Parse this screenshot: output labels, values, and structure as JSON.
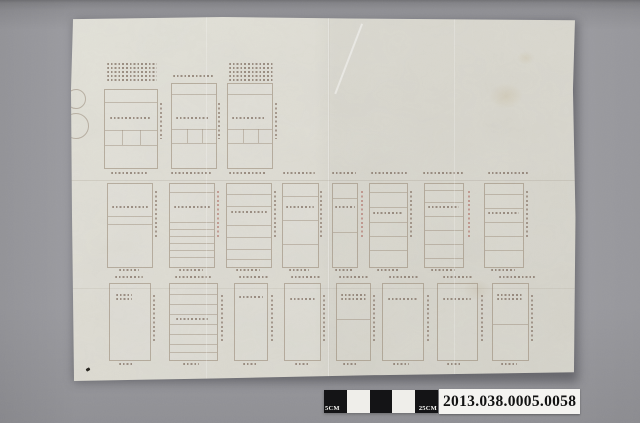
{
  "photo": {
    "accession_label": "2013.038.0005.0058",
    "scale_bar": {
      "label_left": "5CM",
      "label_right": "25CM",
      "segments": [
        "black",
        "white",
        "black",
        "white",
        "black"
      ]
    },
    "colors": {
      "background": "#9c9ca1",
      "paper": "#dedcd3",
      "scale_black": "#141416",
      "scale_white": "#efeeea",
      "label_bg": "#f4f3f0",
      "label_text": "#121212",
      "ink": "#705c4e",
      "ink_red": "#a85c52"
    }
  },
  "sheet": {
    "blocks": [
      {
        "t": "cluster",
        "x": 36,
        "y": 46,
        "w": 50,
        "lines": 5
      },
      {
        "t": "cluster",
        "x": 102,
        "y": 58,
        "w": 40,
        "lines": 1
      },
      {
        "t": "cluster",
        "x": 158,
        "y": 46,
        "w": 44,
        "lines": 5
      },
      {
        "t": "rect",
        "x": 33,
        "y": 72,
        "w": 52,
        "h": 78,
        "rows": [
          12,
          40,
          55
        ],
        "cols": {
          "xs": [
            17,
            35
          ],
          "y0": 40,
          "h": 15
        },
        "text": {
          "x": 5,
          "y": 27,
          "w": 40,
          "lines": 1
        }
      },
      {
        "t": "rect",
        "x": 100,
        "y": 66,
        "w": 44,
        "h": 84,
        "rows": [
          10,
          45,
          59
        ],
        "cols": {
          "xs": [
            15,
            30
          ],
          "y0": 45,
          "h": 14
        },
        "text": {
          "x": 4,
          "y": 33,
          "w": 34,
          "lines": 1
        }
      },
      {
        "t": "rect",
        "x": 156,
        "y": 66,
        "w": 44,
        "h": 84,
        "rows": [
          10,
          45,
          59
        ],
        "cols": {
          "xs": [
            15,
            30
          ],
          "y0": 45,
          "h": 14
        },
        "text": {
          "x": 4,
          "y": 33,
          "w": 34,
          "lines": 1
        }
      },
      {
        "t": "dashv",
        "x": 89,
        "y": 86,
        "h": 36
      },
      {
        "t": "dashv",
        "x": 147,
        "y": 86,
        "h": 36
      },
      {
        "t": "dashv",
        "x": 204,
        "y": 86,
        "h": 36
      },
      {
        "t": "cluster",
        "x": 40,
        "y": 155,
        "w": 36,
        "lines": 1
      },
      {
        "t": "cluster",
        "x": 100,
        "y": 155,
        "w": 40,
        "lines": 1
      },
      {
        "t": "cluster",
        "x": 158,
        "y": 155,
        "w": 38,
        "lines": 1
      },
      {
        "t": "cluster",
        "x": 212,
        "y": 155,
        "w": 32,
        "lines": 1
      },
      {
        "t": "cluster",
        "x": 261,
        "y": 155,
        "w": 24,
        "lines": 1
      },
      {
        "t": "cluster",
        "x": 300,
        "y": 155,
        "w": 36,
        "lines": 1
      },
      {
        "t": "cluster",
        "x": 352,
        "y": 155,
        "w": 40,
        "lines": 1
      },
      {
        "t": "cluster",
        "x": 417,
        "y": 155,
        "w": 40,
        "lines": 1
      },
      {
        "t": "rect",
        "x": 36,
        "y": 166,
        "w": 44,
        "h": 83,
        "rows": [
          32,
          40
        ],
        "text": {
          "x": 4,
          "y": 22,
          "w": 36,
          "lines": 1
        }
      },
      {
        "t": "rect",
        "x": 98,
        "y": 166,
        "w": 44,
        "h": 83,
        "rows": [
          8,
          38,
          45,
          52,
          59,
          66,
          73
        ],
        "text": {
          "x": 4,
          "y": 22,
          "w": 36,
          "lines": 1
        }
      },
      {
        "t": "rect",
        "x": 155,
        "y": 166,
        "w": 44,
        "h": 83,
        "rows": [
          10,
          22,
          41,
          53,
          65,
          75
        ],
        "text": {
          "x": 4,
          "y": 27,
          "w": 36,
          "lines": 1
        }
      },
      {
        "t": "rect",
        "x": 211,
        "y": 166,
        "w": 35,
        "h": 83,
        "rows": [
          12,
          36,
          60
        ],
        "text": {
          "x": 3,
          "y": 22,
          "w": 28,
          "lines": 1
        }
      },
      {
        "t": "rect",
        "x": 261,
        "y": 166,
        "w": 24,
        "h": 83,
        "rows": [
          14,
          48
        ],
        "text": {
          "x": 2,
          "y": 22,
          "w": 20,
          "lines": 1
        }
      },
      {
        "t": "rect",
        "x": 298,
        "y": 166,
        "w": 37,
        "h": 83,
        "rows": [
          8,
          23,
          38,
          52,
          66
        ],
        "text": {
          "x": 3,
          "y": 28,
          "w": 30,
          "lines": 1
        }
      },
      {
        "t": "rect",
        "x": 353,
        "y": 166,
        "w": 38,
        "h": 83,
        "rows": [
          6,
          18,
          32,
          46,
          60,
          74
        ],
        "text": {
          "x": 3,
          "y": 22,
          "w": 31,
          "lines": 1
        }
      },
      {
        "t": "rect",
        "x": 413,
        "y": 166,
        "w": 38,
        "h": 83,
        "rows": [
          10,
          24,
          38,
          52,
          66
        ],
        "text": {
          "x": 3,
          "y": 28,
          "w": 31,
          "lines": 1
        }
      },
      {
        "t": "dashv",
        "x": 84,
        "y": 174,
        "h": 48
      },
      {
        "t": "dashv",
        "x": 146,
        "y": 174,
        "h": 48,
        "r": true
      },
      {
        "t": "dashv",
        "x": 203,
        "y": 174,
        "h": 48
      },
      {
        "t": "dashv",
        "x": 249,
        "y": 174,
        "h": 48
      },
      {
        "t": "dashv",
        "x": 290,
        "y": 174,
        "h": 48,
        "r": true
      },
      {
        "t": "dashv",
        "x": 339,
        "y": 174,
        "h": 48
      },
      {
        "t": "dashv",
        "x": 397,
        "y": 174,
        "h": 48,
        "r": true
      },
      {
        "t": "dashv",
        "x": 455,
        "y": 174,
        "h": 48
      },
      {
        "t": "cluster",
        "x": 48,
        "y": 252,
        "w": 20,
        "lines": 1
      },
      {
        "t": "cluster",
        "x": 108,
        "y": 252,
        "w": 24,
        "lines": 1
      },
      {
        "t": "cluster",
        "x": 165,
        "y": 252,
        "w": 24,
        "lines": 1
      },
      {
        "t": "cluster",
        "x": 218,
        "y": 252,
        "w": 20,
        "lines": 1
      },
      {
        "t": "cluster",
        "x": 264,
        "y": 252,
        "w": 18,
        "lines": 1
      },
      {
        "t": "cluster",
        "x": 306,
        "y": 252,
        "w": 22,
        "lines": 1
      },
      {
        "t": "cluster",
        "x": 360,
        "y": 252,
        "w": 24,
        "lines": 1
      },
      {
        "t": "cluster",
        "x": 420,
        "y": 252,
        "w": 24,
        "lines": 1
      },
      {
        "t": "cluster",
        "x": 44,
        "y": 259,
        "w": 28,
        "lines": 1
      },
      {
        "t": "cluster",
        "x": 104,
        "y": 259,
        "w": 36,
        "lines": 1
      },
      {
        "t": "cluster",
        "x": 168,
        "y": 259,
        "w": 30,
        "lines": 1
      },
      {
        "t": "cluster",
        "x": 220,
        "y": 259,
        "w": 30,
        "lines": 1
      },
      {
        "t": "cluster",
        "x": 268,
        "y": 259,
        "w": 30,
        "lines": 1
      },
      {
        "t": "cluster",
        "x": 318,
        "y": 259,
        "w": 30,
        "lines": 1
      },
      {
        "t": "cluster",
        "x": 372,
        "y": 259,
        "w": 30,
        "lines": 1
      },
      {
        "t": "cluster",
        "x": 428,
        "y": 259,
        "w": 36,
        "lines": 1
      },
      {
        "t": "rect",
        "x": 38,
        "y": 266,
        "w": 40,
        "h": 76,
        "text": {
          "x": 6,
          "y": 10,
          "w": 16,
          "lines": 2
        }
      },
      {
        "t": "rect",
        "x": 98,
        "y": 266,
        "w": 47,
        "h": 76,
        "rows": [
          10,
          20,
          30,
          40,
          50,
          60,
          68
        ],
        "text": {
          "x": 6,
          "y": 34,
          "w": 32,
          "lines": 1
        }
      },
      {
        "t": "rect",
        "x": 163,
        "y": 266,
        "w": 32,
        "h": 76,
        "text": {
          "x": 4,
          "y": 12,
          "w": 24,
          "lines": 1
        }
      },
      {
        "t": "rect",
        "x": 213,
        "y": 266,
        "w": 35,
        "h": 76,
        "text": {
          "x": 5,
          "y": 14,
          "w": 26,
          "lines": 1
        }
      },
      {
        "t": "rect",
        "x": 265,
        "y": 266,
        "w": 33,
        "h": 76,
        "rows": [
          35
        ],
        "text": {
          "x": 4,
          "y": 10,
          "w": 25,
          "lines": 2
        }
      },
      {
        "t": "rect",
        "x": 311,
        "y": 266,
        "w": 40,
        "h": 76,
        "text": {
          "x": 5,
          "y": 14,
          "w": 30,
          "lines": 1
        }
      },
      {
        "t": "rect",
        "x": 366,
        "y": 266,
        "w": 39,
        "h": 76,
        "text": {
          "x": 5,
          "y": 14,
          "w": 28,
          "lines": 1
        }
      },
      {
        "t": "rect",
        "x": 421,
        "y": 266,
        "w": 35,
        "h": 76,
        "rows": [
          40
        ],
        "text": {
          "x": 4,
          "y": 10,
          "w": 26,
          "lines": 2
        }
      },
      {
        "t": "dashv",
        "x": 82,
        "y": 278,
        "h": 46
      },
      {
        "t": "dashv",
        "x": 150,
        "y": 278,
        "h": 46
      },
      {
        "t": "dashv",
        "x": 200,
        "y": 278,
        "h": 46
      },
      {
        "t": "dashv",
        "x": 252,
        "y": 278,
        "h": 46
      },
      {
        "t": "dashv",
        "x": 302,
        "y": 278,
        "h": 46
      },
      {
        "t": "dashv",
        "x": 356,
        "y": 278,
        "h": 46
      },
      {
        "t": "dashv",
        "x": 410,
        "y": 278,
        "h": 46
      },
      {
        "t": "dashv",
        "x": 460,
        "y": 278,
        "h": 46
      },
      {
        "t": "cluster",
        "x": 48,
        "y": 346,
        "w": 14,
        "lines": 1
      },
      {
        "t": "cluster",
        "x": 112,
        "y": 346,
        "w": 16,
        "lines": 1
      },
      {
        "t": "cluster",
        "x": 172,
        "y": 346,
        "w": 14,
        "lines": 1
      },
      {
        "t": "cluster",
        "x": 224,
        "y": 346,
        "w": 14,
        "lines": 1
      },
      {
        "t": "cluster",
        "x": 272,
        "y": 346,
        "w": 14,
        "lines": 1
      },
      {
        "t": "cluster",
        "x": 322,
        "y": 346,
        "w": 16,
        "lines": 1
      },
      {
        "t": "cluster",
        "x": 376,
        "y": 346,
        "w": 14,
        "lines": 1
      },
      {
        "t": "cluster",
        "x": 430,
        "y": 346,
        "w": 16,
        "lines": 1
      },
      {
        "t": "circle",
        "x": -5,
        "y": 72,
        "w": 18,
        "h": 18
      },
      {
        "t": "circle",
        "x": -8,
        "y": 96,
        "w": 24,
        "h": 24
      },
      {
        "t": "fleck",
        "x": 15,
        "y": 351,
        "w": 4,
        "h": 3
      }
    ]
  }
}
